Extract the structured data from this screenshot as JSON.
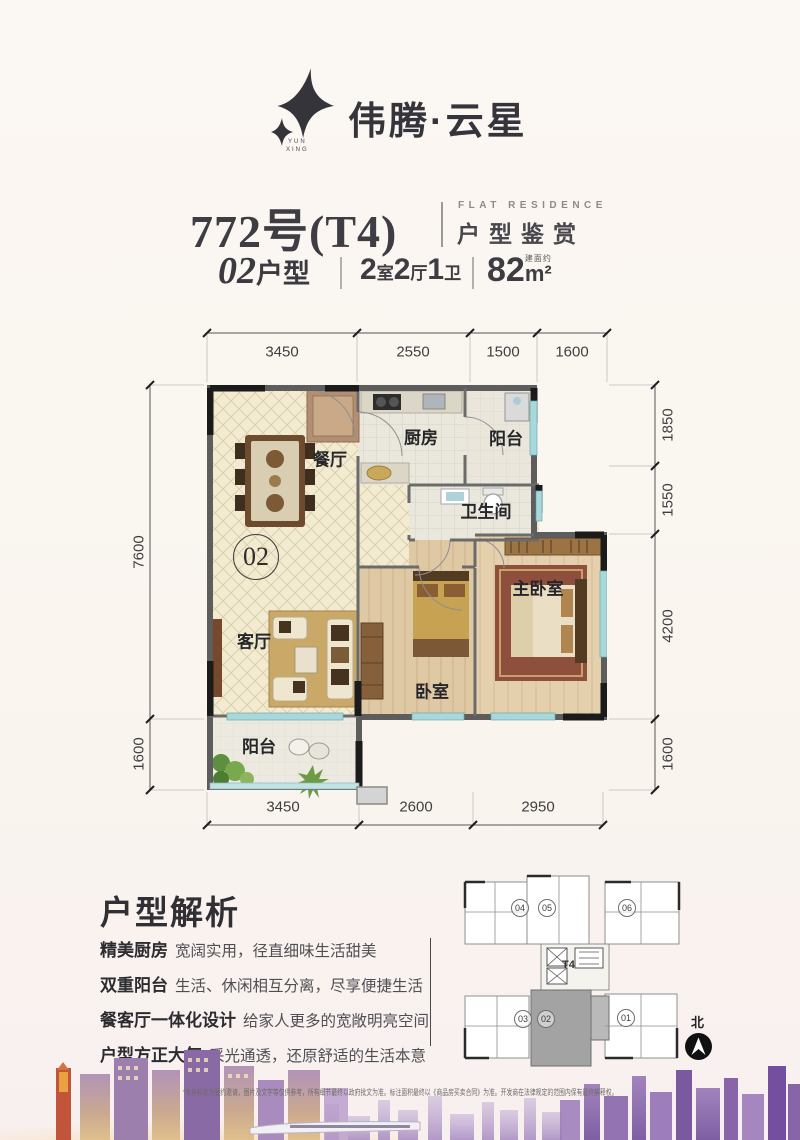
{
  "brand": {
    "name": "伟腾·云星",
    "sub_top": "YUN",
    "sub_bottom": "XING"
  },
  "header": {
    "unit_no": "772号(T4)",
    "series_en": "FLAT RESIDENCE",
    "series_cn": "户型鉴赏",
    "type_num": "02",
    "type_suffix": "户型",
    "layout_parts": [
      {
        "n": "2",
        "u": "室"
      },
      {
        "n": "2",
        "u": "厅"
      },
      {
        "n": "1",
        "u": "卫"
      }
    ],
    "area_num": "82",
    "area_note": "建面约",
    "area_unit": "m²"
  },
  "floorplan": {
    "unit_badge": "02",
    "rooms": {
      "dining": "餐厅",
      "kitchen": "厨房",
      "balcony_top": "阳台",
      "bathroom": "卫生间",
      "living": "客厅",
      "bedroom": "卧室",
      "master": "主卧室",
      "balcony_bottom": "阳台"
    },
    "dimensions": {
      "top": [
        "3450",
        "2550",
        "1500",
        "1600"
      ],
      "bottom": [
        "3450",
        "2600",
        "2950"
      ],
      "left": [
        "7600",
        "1600"
      ],
      "right": [
        "1850",
        "1550",
        "4200",
        "1600"
      ]
    }
  },
  "analysis": {
    "title": "户型解析",
    "items": [
      {
        "head": "精美厨房",
        "desc": "宽阔实用，径直细味生活甜美"
      },
      {
        "head": "双重阳台",
        "desc": "生活、休闲相互分离，尽享便捷生活"
      },
      {
        "head": "餐客厅一体化设计",
        "desc": "给家人更多的宽敞明亮空间"
      },
      {
        "head": "户型方正大气",
        "desc": "采光通透，还原舒适的生活本意"
      }
    ]
  },
  "keyplan": {
    "tower": "T4",
    "units": [
      "04",
      "05",
      "06",
      "03",
      "02",
      "01"
    ],
    "highlight": "02",
    "north": "北"
  },
  "footer": {
    "disclaimer": "*本资料仅为要约邀请，图片及文字等仅供参考，所有细节最终以政府批文为准。标注面积最终以《商品房买卖合同》为准。开发商在法律规定的范围内保有最终解释权。"
  },
  "colors": {
    "accent_dark": "#34343a",
    "wall_gray": "#5d5d5d",
    "floor_cream": "#f2ebd2",
    "floor_wood": "#ddc49f",
    "window_blue": "#a8d8dc",
    "skyline_purple": "#8b6cab"
  }
}
